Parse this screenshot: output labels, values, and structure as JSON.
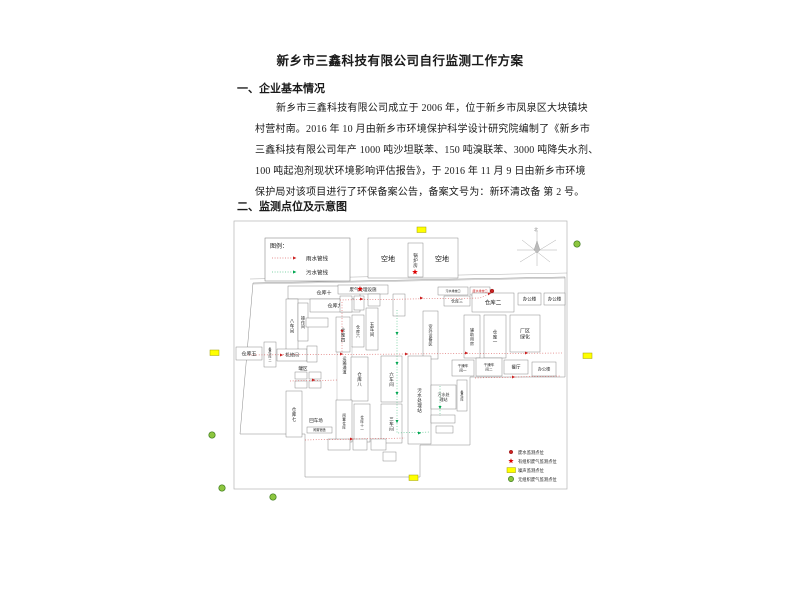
{
  "doc": {
    "title": "新乡市三鑫科技有限公司自行监测工作方案",
    "heading1": "一、企业基本情况",
    "para": [
      "新乡市三鑫科技有限公司成立于 2006 年，位于新乡市凤泉区大块镇块",
      "村营村南。2016 年 10 月由新乡市环境保护科学设计研究院编制了《新乡市",
      "三鑫科技有限公司年产 1000 吨沙坦联苯、150 吨溴联苯、3000 吨降失水剂、",
      "100 吨起泡剂现状环境影响评估报告》，于 2016 年 11 月 9 日由新乡市环境",
      "保护局对该项目进行了环保备案公告，备案文号为：新环清改备 第 2 号。",
      "二、监测点位及示意图"
    ],
    "heading2": "二、监测点位及示意图"
  },
  "diagram": {
    "colors": {
      "red": "#cc2222",
      "green": "#00a651",
      "yellow": "#ffff00",
      "gas_green": "#8dc63f",
      "line": "#777777",
      "frame": "#b5b5b5"
    },
    "frame": {
      "x": 44,
      "y": 1,
      "w": 333,
      "h": 268
    },
    "pipe_legend": {
      "x": 75,
      "y": 18,
      "w": 85,
      "h": 43,
      "title": "图例：",
      "items": [
        {
          "label": "雨水管线",
          "color": "#cc2222"
        },
        {
          "label": "污水管线",
          "color": "#00a651"
        }
      ]
    },
    "compass": {
      "cx": 347,
      "cy": 30,
      "label": "北"
    },
    "boundary": [
      [
        63,
        63
      ],
      [
        375,
        57
      ],
      [
        375,
        157
      ],
      [
        280,
        157
      ],
      [
        280,
        225
      ],
      [
        230,
        225
      ],
      [
        230,
        257
      ],
      [
        115,
        257
      ],
      [
        115,
        214
      ],
      [
        50,
        214
      ]
    ],
    "roads": [
      [
        [
          60,
          59
        ],
        [
          377,
          53
        ]
      ],
      [
        [
          63,
          64
        ],
        [
          375,
          58
        ]
      ]
    ],
    "corridor": [
      [
        [
          147,
          126
        ],
        [
          147,
          180
        ]
      ],
      [
        [
          162,
          126
        ],
        [
          162,
          180
        ]
      ]
    ],
    "buildings": [
      {
        "x": 178,
        "y": 18,
        "w": 90,
        "h": 40,
        "label": "",
        "dir": "h",
        "fs": 3
      },
      {
        "x": 218,
        "y": 23,
        "w": 15,
        "h": 34,
        "label": "锅炉房",
        "dir": "v",
        "fs": 4.5
      },
      {
        "x": 98,
        "y": 66,
        "w": 72,
        "h": 13,
        "label": "仓库十",
        "dir": "h",
        "fs": 5
      },
      {
        "x": 120,
        "y": 79,
        "w": 50,
        "h": 13,
        "label": "仓库九",
        "dir": "h",
        "fs": 5
      },
      {
        "x": 96,
        "y": 79,
        "w": 12,
        "h": 53,
        "label": "八车间",
        "dir": "v",
        "fs": 4.5
      },
      {
        "x": 108,
        "y": 83,
        "w": 10,
        "h": 38,
        "label": "操作间",
        "dir": "v",
        "fs": 4
      },
      {
        "x": 116,
        "y": 98,
        "w": 22,
        "h": 9,
        "label": "",
        "dir": "h",
        "fs": 3
      },
      {
        "x": 148,
        "y": 65,
        "w": 50,
        "h": 9,
        "label": "废气处理设施",
        "dir": "h",
        "fs": 4.5
      },
      {
        "x": 150,
        "y": 76,
        "w": 12,
        "h": 16,
        "label": "",
        "dir": "h",
        "fs": 3
      },
      {
        "x": 164,
        "y": 76,
        "w": 10,
        "h": 14,
        "label": "",
        "dir": "h",
        "fs": 3
      },
      {
        "x": 178,
        "y": 74,
        "w": 12,
        "h": 12,
        "label": "",
        "dir": "h",
        "fs": 3
      },
      {
        "x": 203,
        "y": 74,
        "w": 12,
        "h": 22,
        "label": "",
        "dir": "h",
        "fs": 3
      },
      {
        "x": 248,
        "y": 67,
        "w": 30,
        "h": 8,
        "label": "污水排放口",
        "dir": "h",
        "fs": 3
      },
      {
        "x": 280,
        "y": 67,
        "w": 20,
        "h": 8,
        "label": "废水排放口",
        "dir": "h",
        "fs": 3,
        "tc": "#cc2222"
      },
      {
        "x": 254,
        "y": 76,
        "w": 26,
        "h": 10,
        "label": "仓库三",
        "dir": "h",
        "fs": 4
      },
      {
        "x": 282,
        "y": 73,
        "w": 42,
        "h": 19,
        "label": "仓库二",
        "dir": "h",
        "fs": 5.5
      },
      {
        "x": 328,
        "y": 73,
        "w": 23,
        "h": 12,
        "label": "办公楼",
        "dir": "h",
        "fs": 4.5
      },
      {
        "x": 354,
        "y": 73,
        "w": 21,
        "h": 12,
        "label": "办公楼",
        "dir": "h",
        "fs": 4.5
      },
      {
        "x": 233,
        "y": 91,
        "w": 15,
        "h": 48,
        "label": "室外设备区",
        "dir": "v",
        "fs": 4
      },
      {
        "x": 274,
        "y": 95,
        "w": 16,
        "h": 43,
        "label": "辅助用房",
        "dir": "v",
        "fs": 4
      },
      {
        "x": 294,
        "y": 95,
        "w": 22,
        "h": 43,
        "label": "仓库一",
        "dir": "v",
        "fs": 4.5
      },
      {
        "x": 320,
        "y": 95,
        "w": 30,
        "h": 37,
        "label": "厂区\n绿化",
        "dir": "h",
        "fs": 5
      },
      {
        "x": 146,
        "y": 97,
        "w": 14,
        "h": 35,
        "label": "仓库四",
        "dir": "v",
        "fs": 4.5
      },
      {
        "x": 162,
        "y": 95,
        "w": 12,
        "h": 32,
        "label": "仓库六",
        "dir": "v",
        "fs": 4
      },
      {
        "x": 176,
        "y": 88,
        "w": 12,
        "h": 42,
        "label": "五车间",
        "dir": "v",
        "fs": 4.5
      },
      {
        "x": 46,
        "y": 127,
        "w": 26,
        "h": 13,
        "label": "仓库五",
        "dir": "h",
        "fs": 5
      },
      {
        "x": 74,
        "y": 122,
        "w": 12,
        "h": 25,
        "label": "备件库二",
        "dir": "v",
        "fs": 3.2
      },
      {
        "x": 87,
        "y": 129,
        "w": 30,
        "h": 12,
        "label": "机修间",
        "dir": "h",
        "fs": 4.5
      },
      {
        "x": 117,
        "y": 126,
        "w": 10,
        "h": 16,
        "label": "",
        "dir": "h",
        "fs": 3
      },
      {
        "x": 105,
        "y": 152,
        "w": 12,
        "h": 7,
        "label": "",
        "dir": "h",
        "fs": 3
      },
      {
        "x": 119,
        "y": 152,
        "w": 12,
        "h": 7,
        "label": "",
        "dir": "h",
        "fs": 3
      },
      {
        "x": 105,
        "y": 161,
        "w": 12,
        "h": 7,
        "label": "",
        "dir": "h",
        "fs": 3
      },
      {
        "x": 119,
        "y": 161,
        "w": 12,
        "h": 7,
        "label": "",
        "dir": "h",
        "fs": 3
      },
      {
        "x": 161,
        "y": 137,
        "w": 17,
        "h": 44,
        "label": "仓库八",
        "dir": "v",
        "fs": 4.5
      },
      {
        "x": 191,
        "y": 136,
        "w": 21,
        "h": 46,
        "label": "六车间",
        "dir": "v",
        "fs": 4.5
      },
      {
        "x": 191,
        "y": 184,
        "w": 21,
        "h": 39,
        "label": "三车间",
        "dir": "v",
        "fs": 4.5
      },
      {
        "x": 218,
        "y": 136,
        "w": 23,
        "h": 88,
        "label": "污水处理站",
        "dir": "v",
        "fs": 4.5
      },
      {
        "x": 262,
        "y": 140,
        "w": 22,
        "h": 16,
        "label": "干燥车\n间一",
        "dir": "h",
        "fs": 3.6
      },
      {
        "x": 286,
        "y": 138,
        "w": 26,
        "h": 18,
        "label": "干燥车\n间二",
        "dir": "h",
        "fs": 3.6
      },
      {
        "x": 314,
        "y": 140,
        "w": 24,
        "h": 14,
        "label": "餐厅",
        "dir": "h",
        "fs": 4.5
      },
      {
        "x": 342,
        "y": 142,
        "w": 24,
        "h": 14,
        "label": "办公楼",
        "dir": "h",
        "fs": 4.2
      },
      {
        "x": 241,
        "y": 165,
        "w": 25,
        "h": 24,
        "label": "污水处\n理站",
        "dir": "h",
        "fs": 4
      },
      {
        "x": 267,
        "y": 160,
        "w": 10,
        "h": 31,
        "label": "备件库",
        "dir": "v",
        "fs": 3.2
      },
      {
        "x": 241,
        "y": 195,
        "w": 24,
        "h": 8,
        "label": "",
        "dir": "h",
        "fs": 3
      },
      {
        "x": 246,
        "y": 206,
        "w": 17,
        "h": 7,
        "label": "",
        "dir": "h",
        "fs": 3
      },
      {
        "x": 96,
        "y": 171,
        "w": 16,
        "h": 46,
        "label": "仓库七",
        "dir": "v",
        "fs": 4.5
      },
      {
        "x": 146,
        "y": 180,
        "w": 16,
        "h": 42,
        "label": "闲置仓库",
        "dir": "v",
        "fs": 3.6
      },
      {
        "x": 164,
        "y": 184,
        "w": 16,
        "h": 38,
        "label": "仓库十一",
        "dir": "v",
        "fs": 3.6
      },
      {
        "x": 117,
        "y": 207,
        "w": 25,
        "h": 6,
        "label": "闲置宿舍",
        "dir": "h",
        "fs": 3.2
      },
      {
        "x": 138,
        "y": 219,
        "w": 22,
        "h": 11,
        "label": "",
        "dir": "h",
        "fs": 3
      },
      {
        "x": 163,
        "y": 219,
        "w": 14,
        "h": 11,
        "label": "",
        "dir": "h",
        "fs": 3
      },
      {
        "x": 181,
        "y": 219,
        "w": 15,
        "h": 11,
        "label": "",
        "dir": "h",
        "fs": 3
      },
      {
        "x": 193,
        "y": 232,
        "w": 13,
        "h": 9,
        "label": "",
        "dir": "h",
        "fs": 3
      }
    ],
    "free_labels": [
      {
        "text": "空地",
        "x": 198,
        "y": 41,
        "fs": 7,
        "dir": "h"
      },
      {
        "text": "空地",
        "x": 252,
        "y": 41,
        "fs": 7,
        "dir": "h"
      },
      {
        "text": "罐区",
        "x": 113,
        "y": 150,
        "fs": 4.5,
        "dir": "h"
      },
      {
        "text": "回车场",
        "x": 126,
        "y": 202,
        "fs": 4.5,
        "dir": "h"
      },
      {
        "text": "运输通道",
        "x": 154.5,
        "y": 140,
        "fs": 4,
        "dir": "v"
      }
    ],
    "pipes": [
      {
        "color": "#cc2222",
        "pts": [
          [
            150,
            80
          ],
          [
            290,
            78
          ],
          [
            302,
            73
          ]
        ]
      },
      {
        "color": "#cc2222",
        "pts": [
          [
            58,
            135
          ],
          [
            372,
            133
          ]
        ]
      },
      {
        "color": "#cc2222",
        "pts": [
          [
            152,
            82
          ],
          [
            152,
            133
          ]
        ]
      },
      {
        "color": "#cc2222",
        "pts": [
          [
            115,
            220
          ],
          [
            215,
            218
          ]
        ]
      },
      {
        "color": "#cc2222",
        "pts": [
          [
            285,
            158
          ],
          [
            370,
            156
          ]
        ]
      },
      {
        "color": "#cc2222",
        "pts": [
          [
            100,
            161
          ],
          [
            148,
            160
          ]
        ]
      },
      {
        "color": "#00a651",
        "pts": [
          [
            207,
            90
          ],
          [
            207,
            213
          ],
          [
            240,
            212
          ]
        ]
      },
      {
        "color": "#00a651",
        "pts": [
          [
            250,
            166
          ],
          [
            250,
            196
          ]
        ]
      }
    ],
    "arrows": [
      {
        "x": 170,
        "y": 79,
        "a": 0,
        "c": "#cc2222"
      },
      {
        "x": 230,
        "y": 78,
        "a": 0,
        "c": "#cc2222"
      },
      {
        "x": 298,
        "y": 74,
        "a": -22,
        "c": "#cc2222"
      },
      {
        "x": 90,
        "y": 135,
        "a": 0,
        "c": "#cc2222"
      },
      {
        "x": 150,
        "y": 134,
        "a": 0,
        "c": "#cc2222"
      },
      {
        "x": 215,
        "y": 134,
        "a": 0,
        "c": "#cc2222"
      },
      {
        "x": 275,
        "y": 133,
        "a": 0,
        "c": "#cc2222"
      },
      {
        "x": 335,
        "y": 133,
        "a": 0,
        "c": "#cc2222"
      },
      {
        "x": 152,
        "y": 110,
        "a": 90,
        "c": "#cc2222"
      },
      {
        "x": 160,
        "y": 219,
        "a": 0,
        "c": "#cc2222"
      },
      {
        "x": 322,
        "y": 157,
        "a": 0,
        "c": "#cc2222"
      },
      {
        "x": 122,
        "y": 160,
        "a": 0,
        "c": "#cc2222"
      },
      {
        "x": 207,
        "y": 112,
        "a": 90,
        "c": "#00a651"
      },
      {
        "x": 207,
        "y": 142,
        "a": 90,
        "c": "#00a651"
      },
      {
        "x": 207,
        "y": 172,
        "a": 90,
        "c": "#00a651"
      },
      {
        "x": 207,
        "y": 200,
        "a": 90,
        "c": "#00a651"
      },
      {
        "x": 228,
        "y": 213,
        "a": 0,
        "c": "#00a651"
      },
      {
        "x": 250,
        "y": 186,
        "a": 90,
        "c": "#00a651"
      }
    ],
    "noise_points": [
      [
        227,
        7
      ],
      [
        20,
        130
      ],
      [
        393,
        133
      ],
      [
        219,
        255
      ]
    ],
    "gas_points": [
      [
        387,
        24
      ],
      [
        22,
        215
      ],
      [
        32,
        268
      ],
      [
        83,
        277
      ]
    ],
    "star_points": [
      [
        170,
        69
      ],
      [
        225,
        52
      ]
    ],
    "waste_points": [
      [
        302,
        71
      ]
    ],
    "point_legend": {
      "x": 316,
      "y": 228,
      "items": [
        {
          "marker": "red-dot",
          "label": "废水监测点位"
        },
        {
          "marker": "red-star",
          "label": "有组织废气监测点位"
        },
        {
          "marker": "yellow-rect",
          "label": "噪声监测点位"
        },
        {
          "marker": "green-circle",
          "label": "无组织废气监测点位"
        }
      ]
    }
  }
}
